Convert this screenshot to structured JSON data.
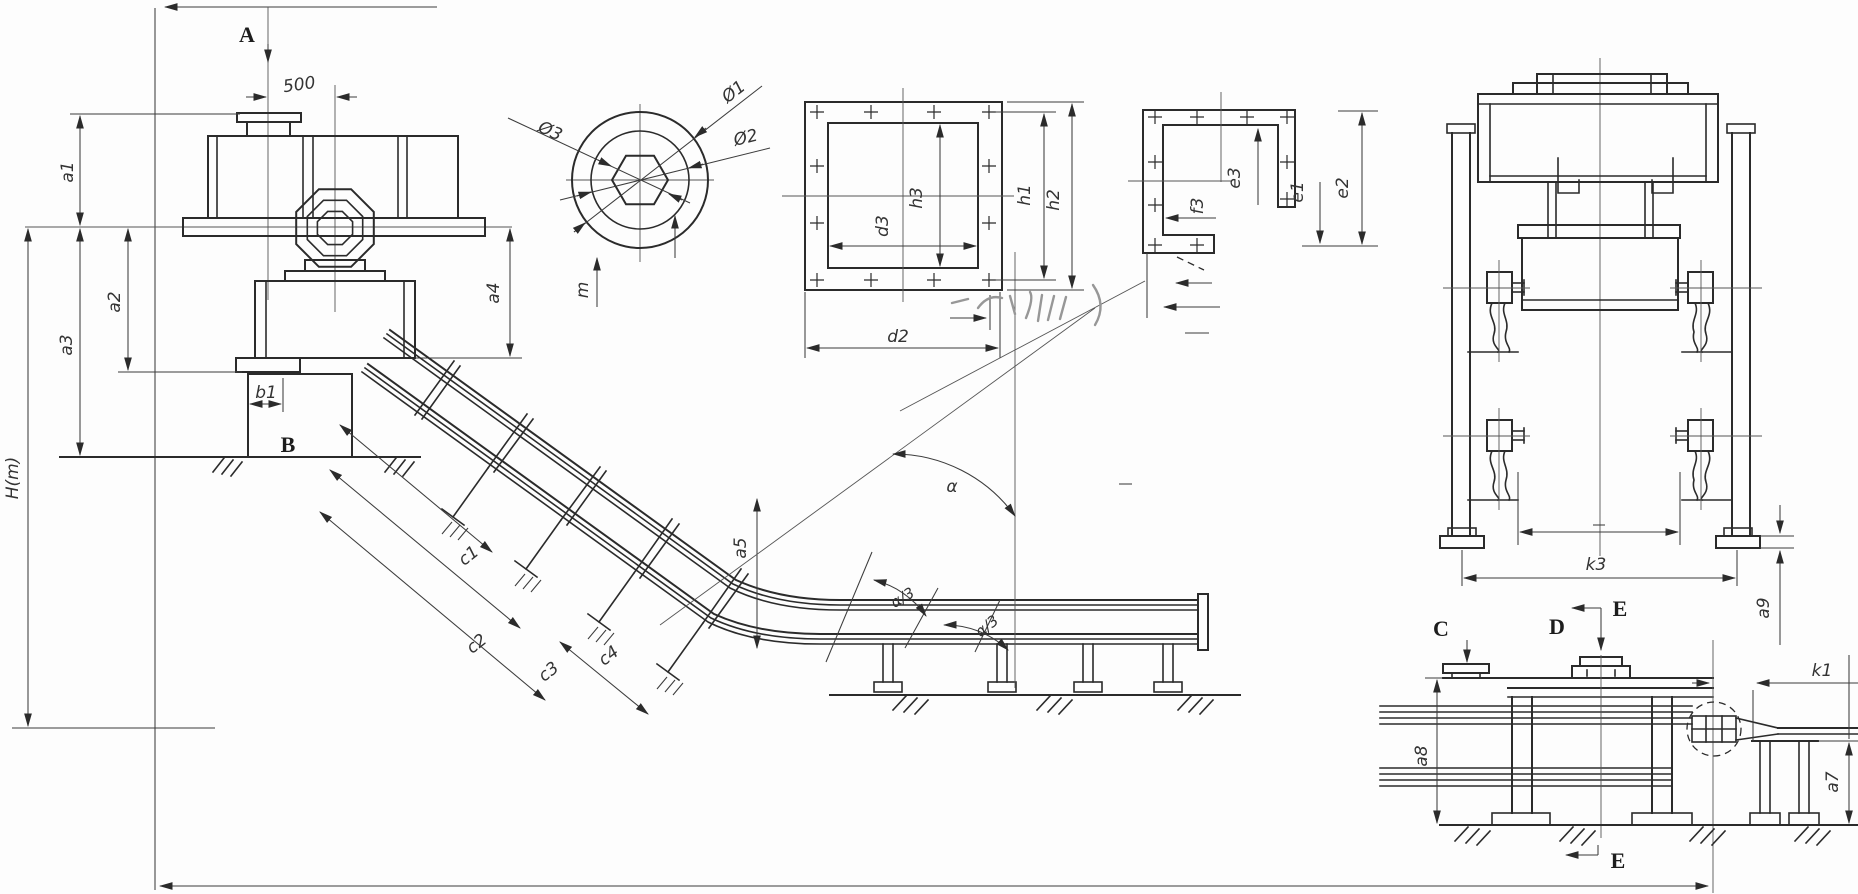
{
  "drawing": {
    "description": "engineering dimension diagram of an inclined Z-type conveyor with head drive, curved section, horizontal run, shaft section detail, square flange detail, channel flange detail, trestle front elevation and tail side view",
    "colors": {
      "line": "#2b2b2b",
      "thin": "#3c3c3c",
      "label": "#333333",
      "background": "#fdfdfd",
      "smudge": "#979797"
    },
    "labels": {
      "section_a": "A",
      "dim_500": "500",
      "a1": "a1",
      "a2": "a2",
      "a3": "a3",
      "a4": "a4",
      "a5": "a5",
      "b1": "b1",
      "section_b": "B",
      "h_m": "H(m)",
      "c1": "c1",
      "c2": "c2",
      "c3": "c3",
      "c4": "c4",
      "alpha": "α",
      "alpha_third": "α/3",
      "m": "m",
      "phi1": "Ø1",
      "phi2": "Ø2",
      "phi3": "Ø3",
      "h1": "h1",
      "h2": "h2",
      "h3": "h3",
      "d3": "d3",
      "d2": "d2",
      "e1": "e1",
      "e2": "e2",
      "e3": "e3",
      "f3": "f3",
      "k3": "k3",
      "a9": "a9",
      "section_c": "C",
      "section_d": "D",
      "section_e": "E",
      "k1": "k1",
      "a7": "a7",
      "a8": "a8"
    }
  }
}
